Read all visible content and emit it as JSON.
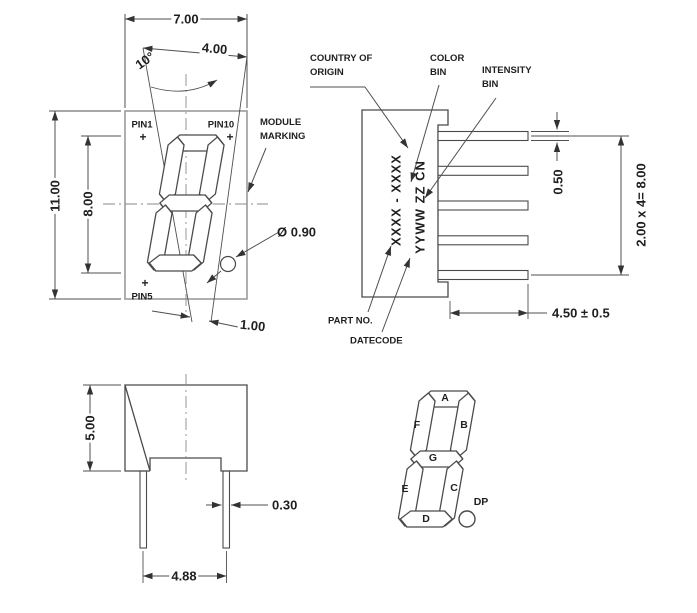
{
  "front_view": {
    "dim_width": "7.00",
    "dim_digit_width": "4.00",
    "dim_angle": "10°",
    "dim_height": "11.00",
    "dim_digit_height": "8.00",
    "dim_dp_diameter": "Ø 0.90",
    "dim_offset": "1.00",
    "pin1": "PIN1",
    "pin10": "PIN10",
    "pin5": "PIN5",
    "pin_marker": "+",
    "module_marking": {
      "lines": [
        "MODULE",
        "MARKING"
      ]
    }
  },
  "side_view": {
    "country_of_origin": {
      "lines": [
        "COUNTRY OF",
        "ORIGIN"
      ]
    },
    "color_bin": {
      "lines": [
        "COLOR",
        "BIN"
      ]
    },
    "intensity_bin": {
      "lines": [
        "INTENSITY",
        "BIN"
      ]
    },
    "part_no_label": "PART NO.",
    "datecode_label": "DATECODE",
    "marking_part": "XXXX - XXXX",
    "marking_date": "YYWW ZZ CN",
    "dim_pin_thickness": "0.50",
    "dim_pin_pitch": "2.00 x 4= 8.00",
    "dim_pin_length": "4.50 ± 0.5"
  },
  "bottom_view": {
    "dim_height": "5.00",
    "dim_pin_width": "0.30",
    "dim_pin_spacing": "4.88"
  },
  "segment_diagram": {
    "a": "A",
    "b": "B",
    "c": "C",
    "d": "D",
    "e": "E",
    "f": "F",
    "g": "G",
    "dp": "DP"
  },
  "colors": {
    "line": "#4f4f4f",
    "body_outline": "#9b9b9b",
    "text": "#1f1f1f",
    "background": "#ffffff"
  }
}
